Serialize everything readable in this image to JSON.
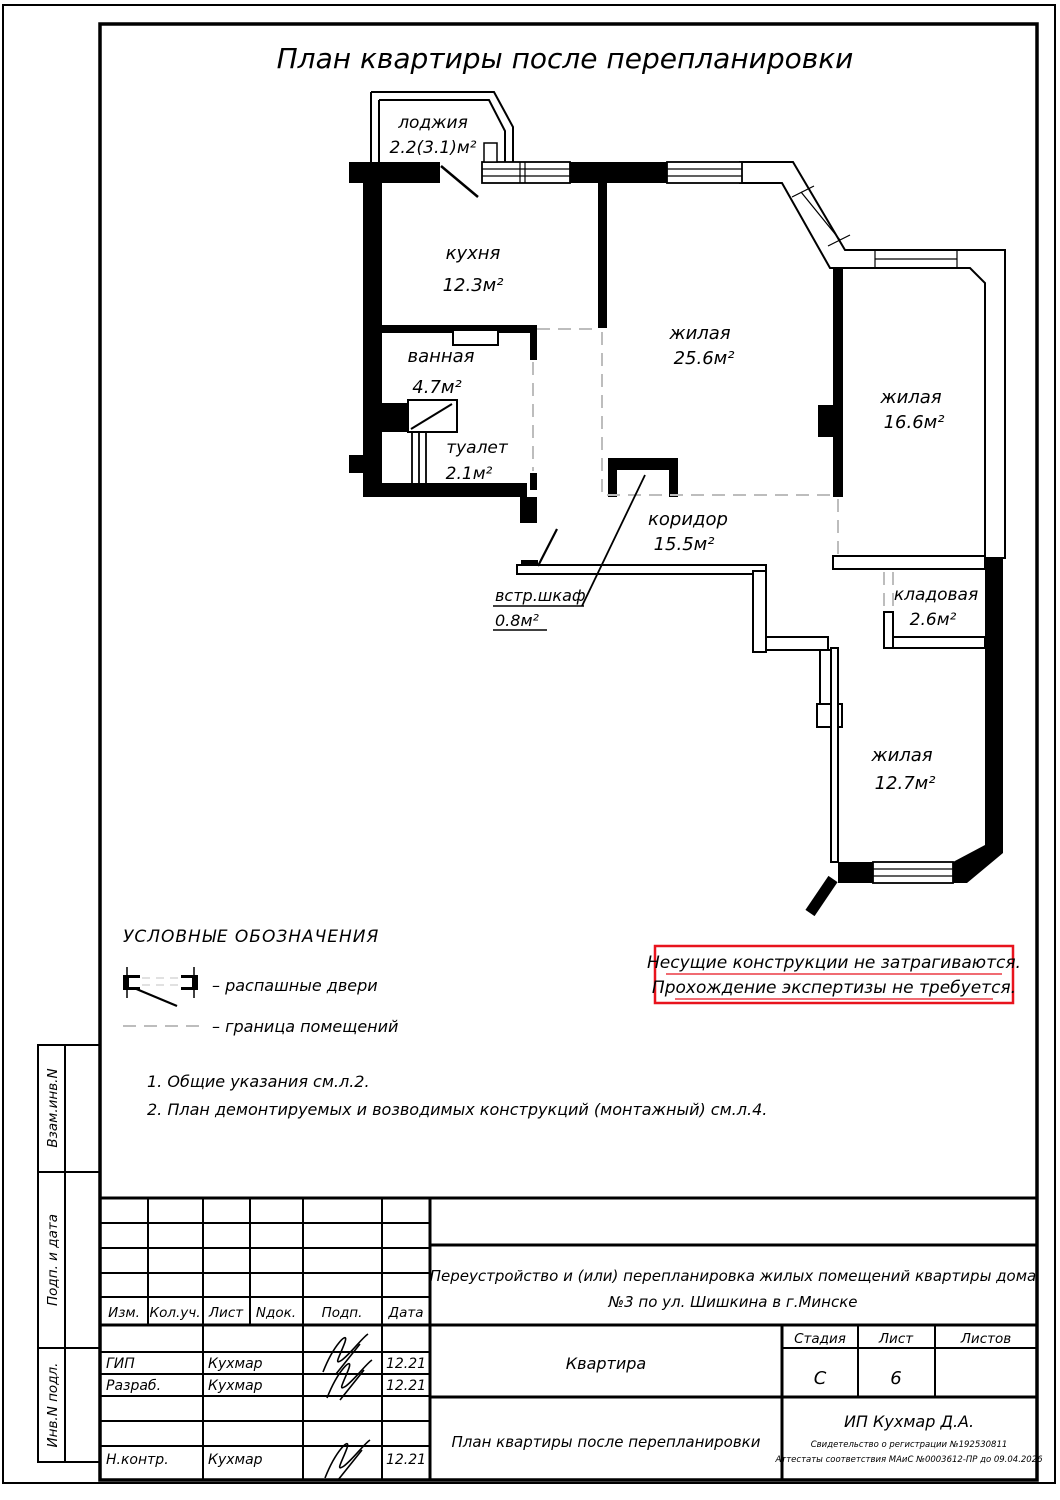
{
  "title": "План квартиры после перепланировки",
  "rooms": [
    {
      "name": "лоджия",
      "area": "2.2(3.1)м²"
    },
    {
      "name": "кухня",
      "area": "12.3м²"
    },
    {
      "name": "ванная",
      "area": "4.7м²"
    },
    {
      "name": "туалет",
      "area": "2.1м²"
    },
    {
      "name": "жилая",
      "area": "25.6м²"
    },
    {
      "name": "жилая",
      "area": "16.6м²"
    },
    {
      "name": "коридор",
      "area": "15.5м²"
    },
    {
      "name": "встр.шкаф",
      "area": "0.8м²"
    },
    {
      "name": "кладовая",
      "area": "2.6м²"
    },
    {
      "name": "жилая",
      "area": "12.7м²"
    }
  ],
  "legend": {
    "title": "УСЛОВНЫЕ ОБОЗНАЧЕНИЯ",
    "swing_doors": "– распашные двери",
    "room_border": "– граница помещений"
  },
  "notes": {
    "n1": "1. Общие указания см.л.2.",
    "n2": "2. План демонтируемых и возводимых конструкций (монтажный) см.л.4."
  },
  "warning": {
    "line1": "Несущие конструкции не затрагиваются.",
    "line2": "Прохождение экспертизы не требуется.",
    "color": "#e8131d"
  },
  "sidebar": {
    "c1": "Взам.инв.N",
    "c2": "Подп. и дата",
    "c3": "Инв.N подл."
  },
  "stamp": {
    "headers": [
      "Изм.",
      "Кол.уч.",
      "Лист",
      "Nдок.",
      "Подп.",
      "Дата"
    ],
    "rows": [
      {
        "role": "ГИП",
        "name": "Кухмар",
        "date": "12.21"
      },
      {
        "role": "Разраб.",
        "name": "Кухмар",
        "date": "12.21"
      },
      {
        "role": "Н.контр.",
        "name": "Кухмар",
        "date": "12.21"
      }
    ],
    "doc1": "Переустройство и (или) перепланировка жилых помещений квартиры дома",
    "doc2": "№3  по ул. Шишкина в г.Минске",
    "object": "Квартира",
    "stage_label": "Стадия",
    "sheet_label": "Лист",
    "sheets_label": "Листов",
    "stage": "С",
    "sheet": "6",
    "sheets": "",
    "sheet_title": "План квартиры после перепланировки",
    "company": "ИП Кухмар Д.А.",
    "cert1": "Свидетельство о регистрации №192530811",
    "cert2": "Аттестаты соответствия МАиС №0003612-ПР до 09.04.2026"
  }
}
